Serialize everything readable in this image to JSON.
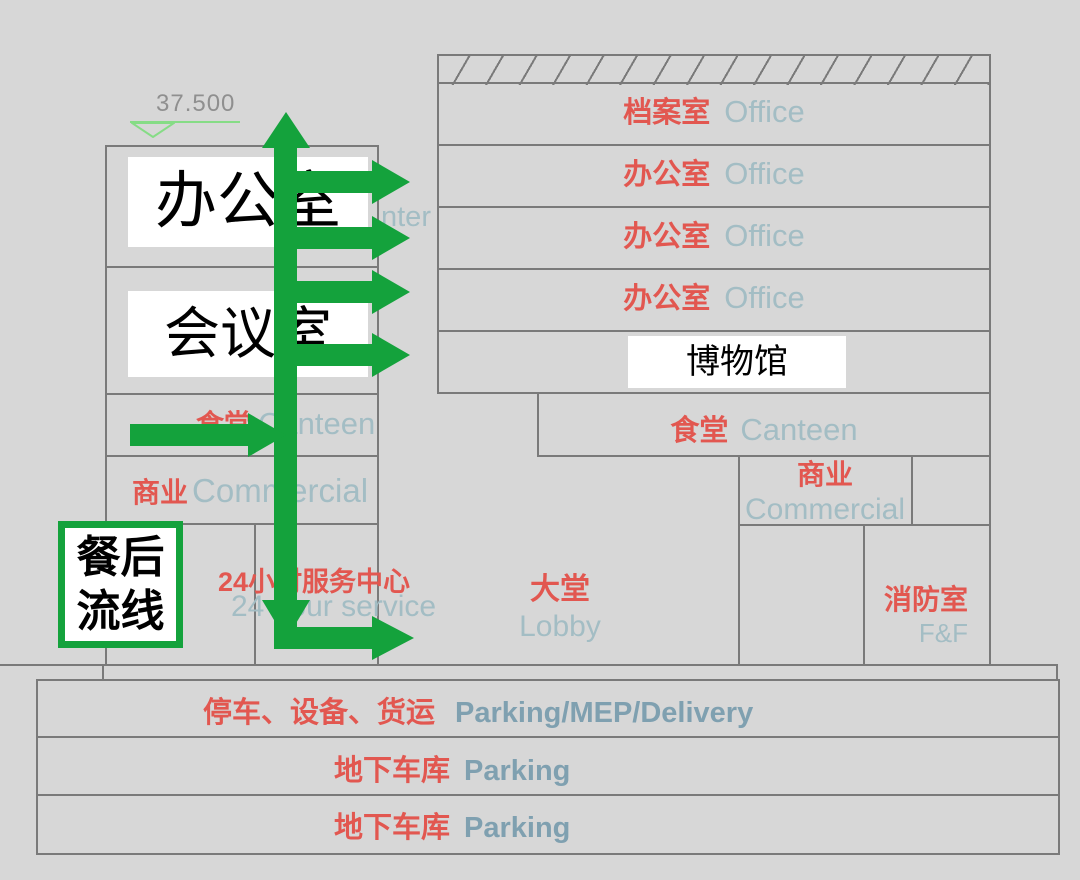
{
  "colors": {
    "bg": "#d7d7d7",
    "line": "#7a7a7a",
    "red": "#e25750",
    "blue": "#a3bdc4",
    "blue-bold": "#7fa0b0",
    "green": "#14a23c",
    "green-light": "#86dc86"
  },
  "elevation": {
    "value": "37.500"
  },
  "flow_box": {
    "line1": "餐后",
    "line2": "流线"
  },
  "left_building": {
    "office": "办公室",
    "meeting": "会议室",
    "canteen": {
      "zh": "食堂",
      "en": "Canteen"
    },
    "commercial": {
      "zh": "商业",
      "en": "Commercial"
    },
    "service": {
      "zh": "24小时服务中心",
      "en": "24 hour service"
    },
    "covered_text_fragment": "nter"
  },
  "right_building": {
    "floors": [
      {
        "zh": "档案室",
        "en": "Office"
      },
      {
        "zh": "办公室",
        "en": "Office"
      },
      {
        "zh": "办公室",
        "en": "Office"
      },
      {
        "zh": "办公室",
        "en": "Office"
      }
    ],
    "museum": "博物馆",
    "canteen": {
      "zh": "食堂",
      "en": "Canteen"
    },
    "commercial": {
      "zh": "商业",
      "en": "Commercial"
    },
    "lobby": {
      "zh": "大堂",
      "en": "Lobby"
    },
    "fire_room": {
      "zh": "消防室",
      "en": "F&F"
    }
  },
  "basement": {
    "levels": [
      {
        "zh": "停车、设备、货运",
        "en": "Parking/MEP/Delivery"
      },
      {
        "zh": "地下车库",
        "en": "Parking"
      },
      {
        "zh": "地下车库",
        "en": "Parking"
      }
    ]
  }
}
